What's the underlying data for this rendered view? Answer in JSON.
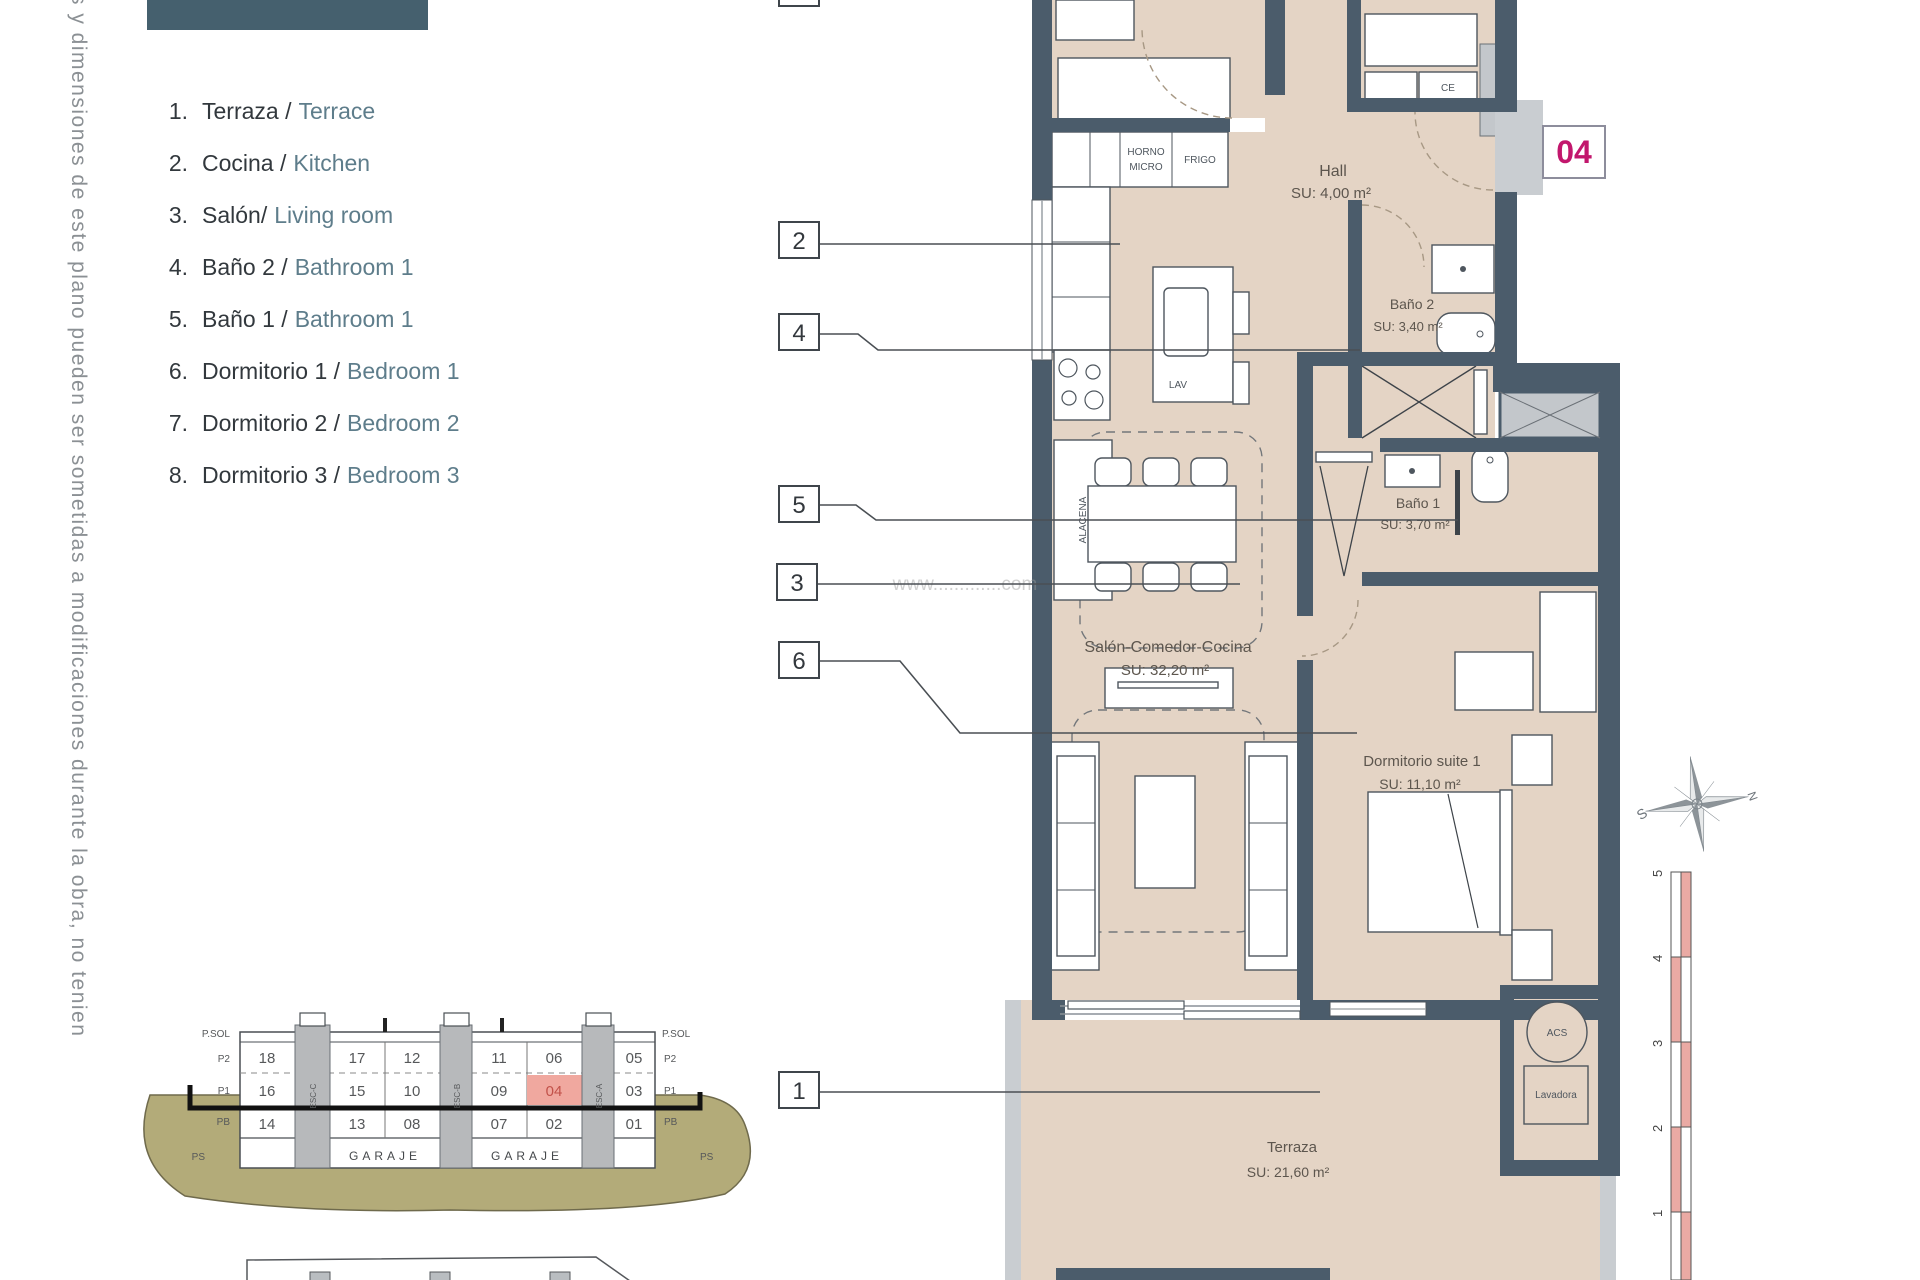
{
  "side_note": "s y dimensiones de este plano pueden ser sometidas a modificaciones durante la obra, no tenien",
  "legend": {
    "items": [
      {
        "num": "1.",
        "es": "Terraza /",
        "en": "Terrace"
      },
      {
        "num": "2.",
        "es": "Cocina /",
        "en": "Kitchen"
      },
      {
        "num": "3.",
        "es": "Salón/",
        "en": "Living room"
      },
      {
        "num": "4.",
        "es": "Baño 2 /",
        "en": "Bathroom 1"
      },
      {
        "num": "5.",
        "es": "Baño 1 /",
        "en": "Bathroom 1"
      },
      {
        "num": "6.",
        "es": "Dormitorio 1 /",
        "en": "Bedroom 1"
      },
      {
        "num": "7.",
        "es": "Dormitorio 2 /",
        "en": "Bedroom 2"
      },
      {
        "num": "8.",
        "es": "Dormitorio 3 /",
        "en": "Bedroom 3"
      }
    ]
  },
  "unit_badge": "04",
  "markers": [
    "2",
    "4",
    "5",
    "3",
    "6",
    "1"
  ],
  "rooms": {
    "hall": {
      "name": "Hall",
      "area": "SU: 4,00 m²"
    },
    "bano2": {
      "name": "Baño 2",
      "area": "SU: 3,40 m²"
    },
    "bano1": {
      "name": "Baño 1",
      "area": "SU: 3,70 m²"
    },
    "salon": {
      "name": "Salón-Comedor-Cocina",
      "area": "SU: 32,20 m²"
    },
    "suite": {
      "name": "Dormitorio suite 1",
      "area": "SU: 11,10 m²"
    },
    "terraza": {
      "name": "Terraza",
      "area": "SU: 21,60 m²"
    }
  },
  "labels": {
    "horno": "HORNO",
    "micro": "MICRO",
    "frigo": "FRIGO",
    "lav": "LAV",
    "alacena": "ALACENA",
    "ce": "CE",
    "acs": "ACS",
    "lavadora": "Lavadora"
  },
  "watermark": "www.............com",
  "compass": {
    "n": "N",
    "s": "S"
  },
  "scale_bar": {
    "ticks": [
      "5",
      "4",
      "3",
      "2",
      "1"
    ]
  },
  "cross_section": {
    "floors": [
      "P.SOL",
      "P2",
      "P1",
      "PB",
      "PS"
    ],
    "rows": {
      "p2": [
        "18",
        "17",
        "12",
        "11",
        "06",
        "05"
      ],
      "p1": [
        "16",
        "15",
        "10",
        "09",
        "04",
        "03"
      ],
      "pb": [
        "14",
        "13",
        "08",
        "07",
        "02",
        "01"
      ]
    },
    "shafts": [
      "ESC-C",
      "ESC-B",
      "ESC-A"
    ],
    "garage": [
      "GARAJE",
      "GARAJE"
    ]
  },
  "colors": {
    "wall": "#4b5c6b",
    "floor": "#e4d4c5",
    "accent": "#c2176d",
    "highlight": "#f0a89f",
    "ground": "#b3ab79"
  }
}
